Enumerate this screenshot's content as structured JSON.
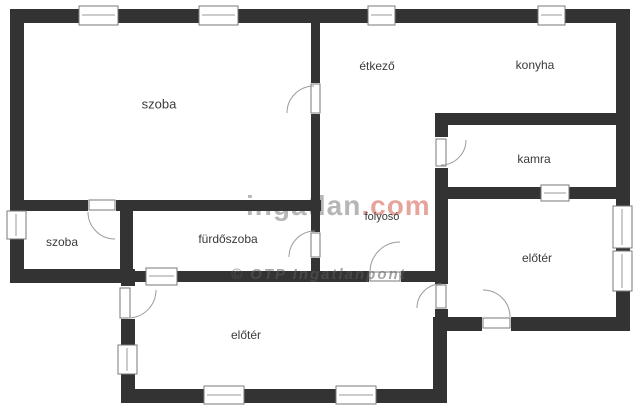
{
  "title": "floor-plan",
  "palette": {
    "wall": "#333333",
    "label_text": "#3a3a3a",
    "door_arc": "#9b9b9b",
    "watermark_gray": "#aaaaaa",
    "watermark_red": "#e2958b"
  },
  "rooms": [
    {
      "id": "szoba-large",
      "label": "szoba"
    },
    {
      "id": "etkezo",
      "label": "étkező"
    },
    {
      "id": "konyha",
      "label": "konyha"
    },
    {
      "id": "kamra",
      "label": "kamra"
    },
    {
      "id": "szoba-small",
      "label": "szoba"
    },
    {
      "id": "furdoszoba",
      "label": "fürdőszoba"
    },
    {
      "id": "folyoso",
      "label": "folyosó"
    },
    {
      "id": "eloter-right",
      "label": "előtér"
    },
    {
      "id": "eloter-bottom",
      "label": "előtér"
    }
  ],
  "watermarks": {
    "brand_name": "ingatlan",
    "brand_tld": ".com",
    "secondary": "© OTP Ingatlanpont"
  }
}
